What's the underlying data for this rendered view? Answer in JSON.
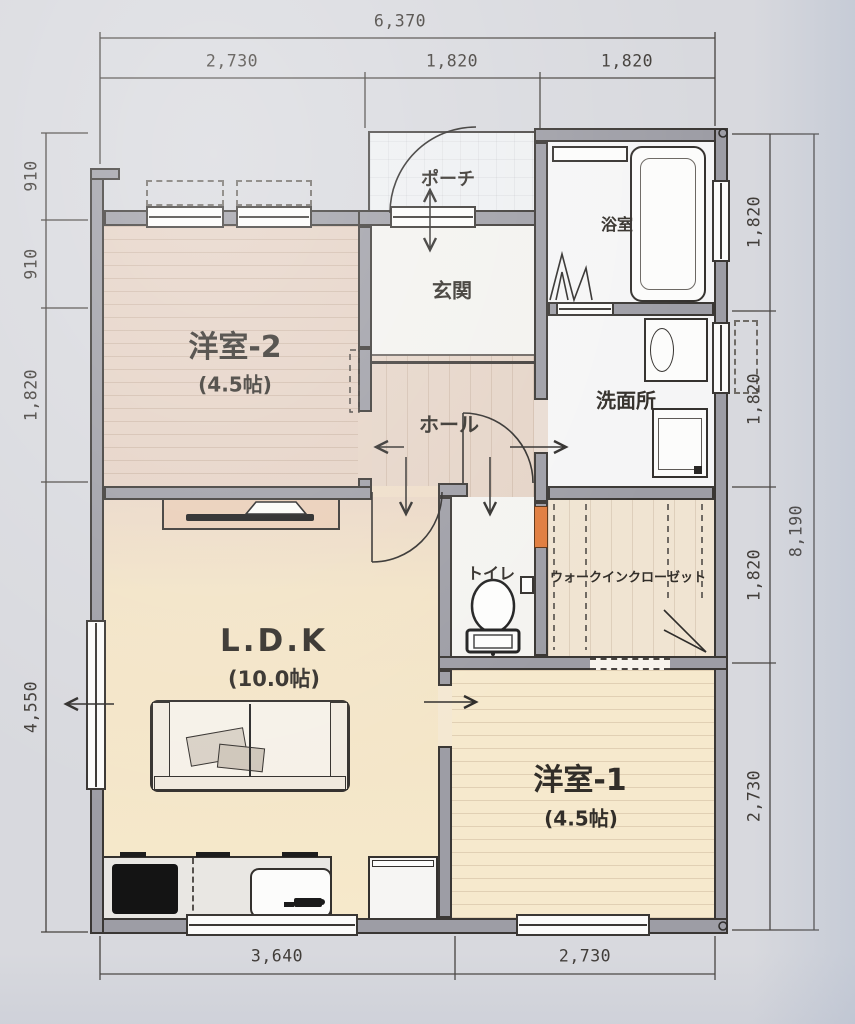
{
  "plan_title": "1LDK+2room floor plan",
  "rooms": {
    "yoshitsu2": {
      "name": "洋室-2",
      "size": "(4.5帖)"
    },
    "ldk": {
      "name": "L.D.K",
      "size": "(10.0帖)"
    },
    "yoshitsu1": {
      "name": "洋室-1",
      "size": "(4.5帖)"
    },
    "porch": {
      "name": "ポーチ"
    },
    "genkan": {
      "name": "玄関"
    },
    "bath": {
      "name": "浴室"
    },
    "washroom": {
      "name": "洗面所"
    },
    "hall": {
      "name": "ホール"
    },
    "toilet": {
      "name": "トイレ"
    },
    "wic": {
      "name": "ウォークインクローゼット"
    }
  },
  "dimensions": {
    "top_total": "6,370",
    "top_segments": [
      "2,730",
      "1,820",
      "1,820"
    ],
    "left": [
      "910",
      "910",
      "1,820",
      "4,550"
    ],
    "right": [
      "1,820",
      "1,820",
      "1,820",
      "2,730"
    ],
    "right_total": "8,190",
    "bottom": [
      "3,640",
      "2,730"
    ]
  },
  "colors": {
    "wall": "#9d9da5",
    "outline": "#3a3734",
    "floor_wood_warm": "#f4e7cb",
    "floor_wood_pink": "#e5d3c6",
    "accent_orange": "#e07b3c",
    "paper": "#e9e9ec"
  }
}
